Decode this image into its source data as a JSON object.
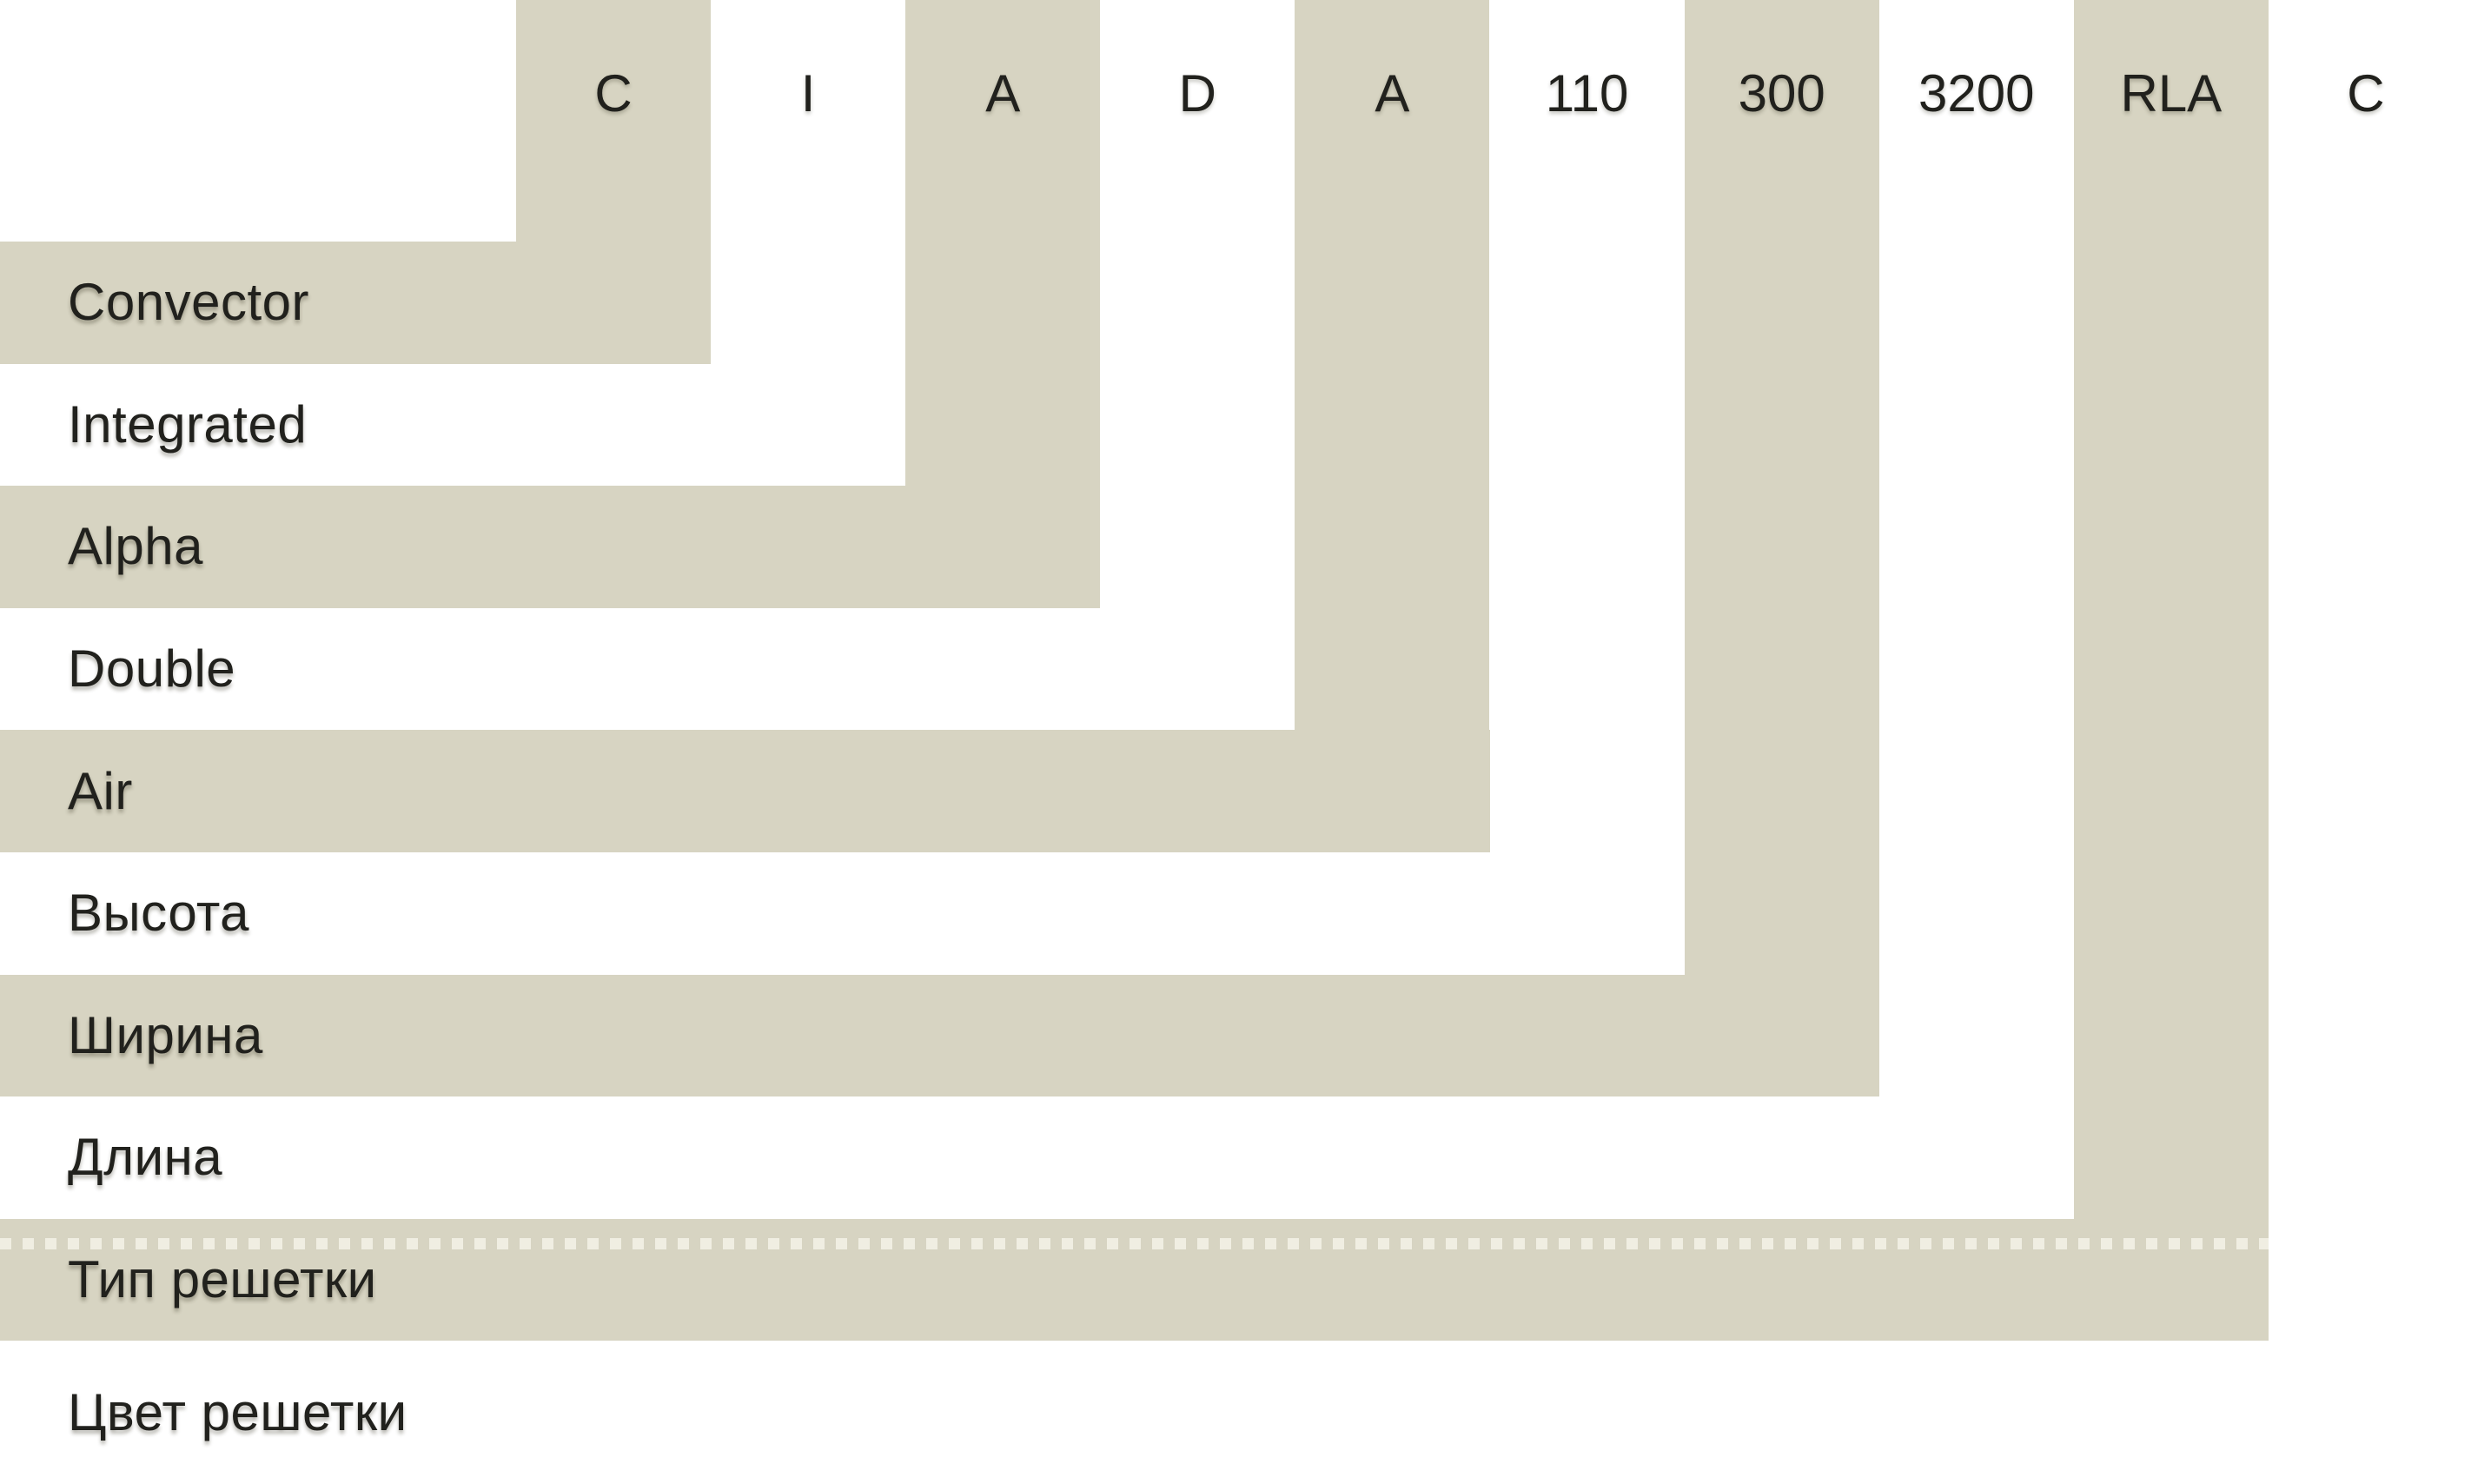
{
  "diagram": {
    "colors": {
      "band": "#d7d4c2",
      "background": "#ffffff",
      "text": "#21211d",
      "dash": "rgba(255,254,245,0.62)"
    },
    "items": [
      {
        "code": "C",
        "label": "Convector",
        "shaded": true,
        "dotted": false
      },
      {
        "code": "I",
        "label": "Integrated",
        "shaded": false,
        "dotted": false
      },
      {
        "code": "A",
        "label": "Alpha",
        "shaded": true,
        "dotted": false
      },
      {
        "code": "D",
        "label": "Double",
        "shaded": false,
        "dotted": false
      },
      {
        "code": "A",
        "label": "Air",
        "shaded": true,
        "dotted": false
      },
      {
        "code": "110",
        "label": "Высота",
        "shaded": false,
        "dotted": false
      },
      {
        "code": "300",
        "label": "Ширина",
        "shaded": true,
        "dotted": false
      },
      {
        "code": "3200",
        "label": "Длина",
        "shaded": false,
        "dotted": false
      },
      {
        "code": "RLA",
        "label": "Тип решетки",
        "shaded": true,
        "dotted": true
      },
      {
        "code": "C",
        "label": "Цвет решетки",
        "shaded": false,
        "dotted": false
      }
    ]
  }
}
